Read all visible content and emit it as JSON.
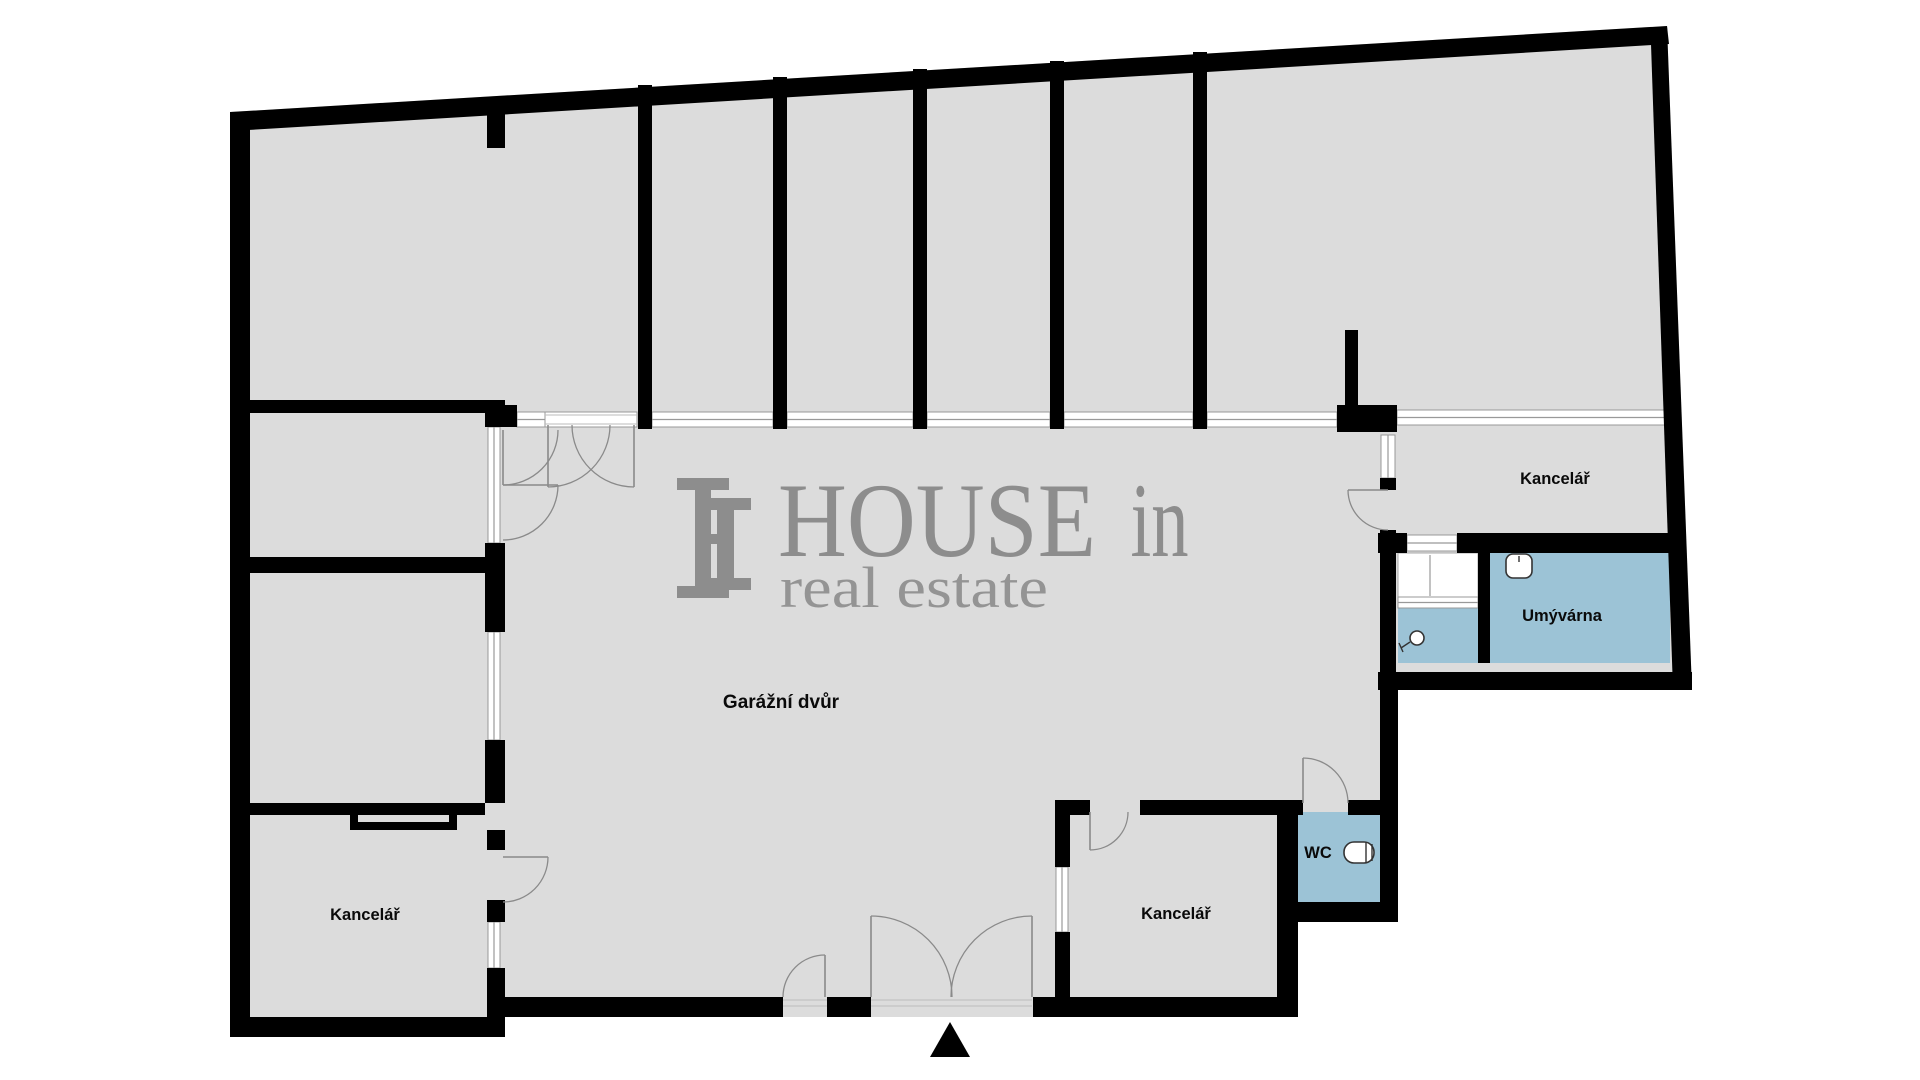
{
  "watermark": {
    "brand_main": "HOUSE",
    "brand_suffix": "in",
    "tagline": "real estate"
  },
  "rooms": {
    "garage_yard": "Garážní dvůr",
    "office_top_right": "Kancelář",
    "washroom": "Umývárna",
    "wc": "WC",
    "office_bottom_middle": "Kancelář",
    "office_bottom_left": "Kancelář"
  },
  "colors": {
    "background": "#ffffff",
    "room_fill": "#dcdcdc",
    "wet_room_fill": "#9cc3d6",
    "wall": "#000000",
    "window_line": "#999999",
    "door_arc": "#8a8a8a",
    "label_text": "#0a0a0a",
    "watermark": "#8d8d8d"
  }
}
